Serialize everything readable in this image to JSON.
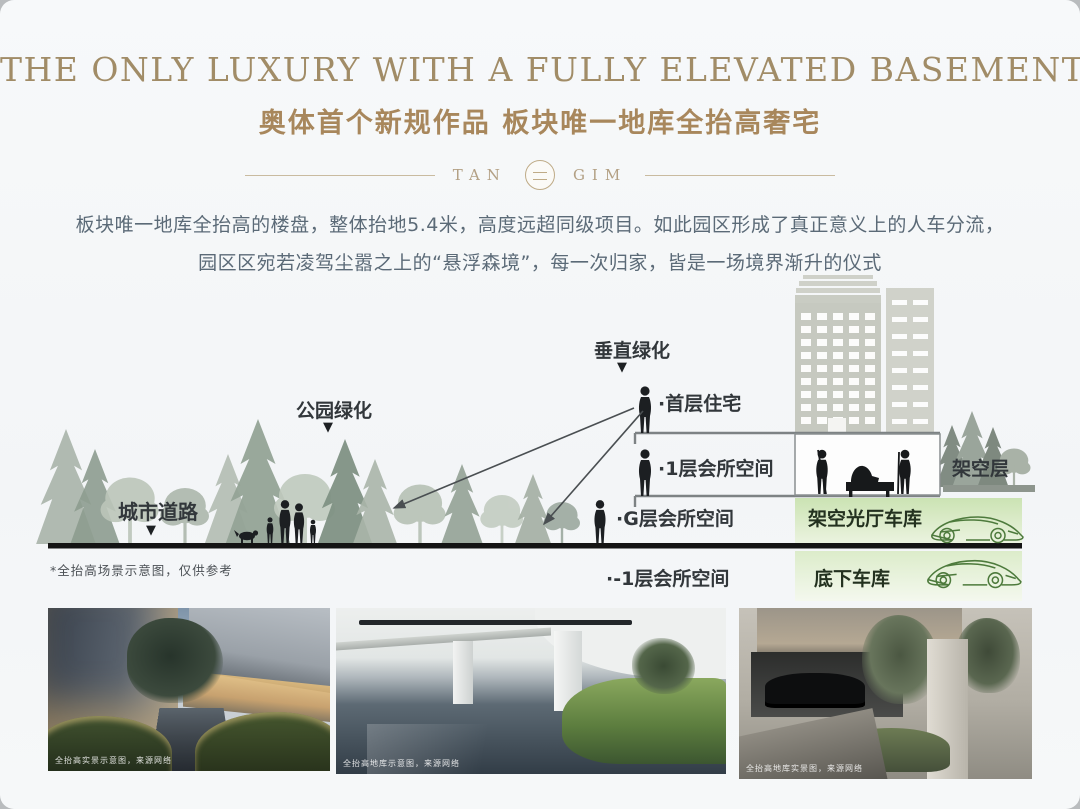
{
  "header": {
    "title_en": "THE ONLY LUXURY WITH A FULLY ELEVATED BASEMENT",
    "title_zh": "奥体首个新规作品 板块唯一地库全抬高奢宅",
    "logo": {
      "left": "TAN",
      "right": "GIM"
    }
  },
  "intro": {
    "line1": "板块唯一地库全抬高的楼盘，整体抬地5.4米，高度远超同级项目。如此园区形成了真正意义上的人车分流，",
    "line2": "园区区宛若凌驾尘嚣之上的“悬浮森境”，每一次归家，皆是一场境界渐升的仪式"
  },
  "diagram": {
    "marker": "▼",
    "callouts": {
      "vertical_green": "垂直绿化",
      "park_green": "公园绿化",
      "city_road": "城市道路"
    },
    "levels": {
      "first_floor": "·首层住宅",
      "l1_club": "·1层会所空间",
      "stilt_floor": "架空层",
      "g_club": "·G层会所空间",
      "stilt_garage": "架空光厅车库",
      "b1_club": "·-1层会所空间",
      "underground_garage": "底下车库"
    },
    "note": "*全抬高场景示意图，仅供参考"
  },
  "photos": [
    {
      "caption": "全抬高实景示意图，来源网络"
    },
    {
      "caption": "全抬高地库示意图，来源网络"
    },
    {
      "caption": "全抬高地库实景图，来源网络"
    }
  ],
  "colors": {
    "accent_gold": "#a18c67",
    "garage_green": "#cde4b6",
    "ink": "#32373b"
  }
}
